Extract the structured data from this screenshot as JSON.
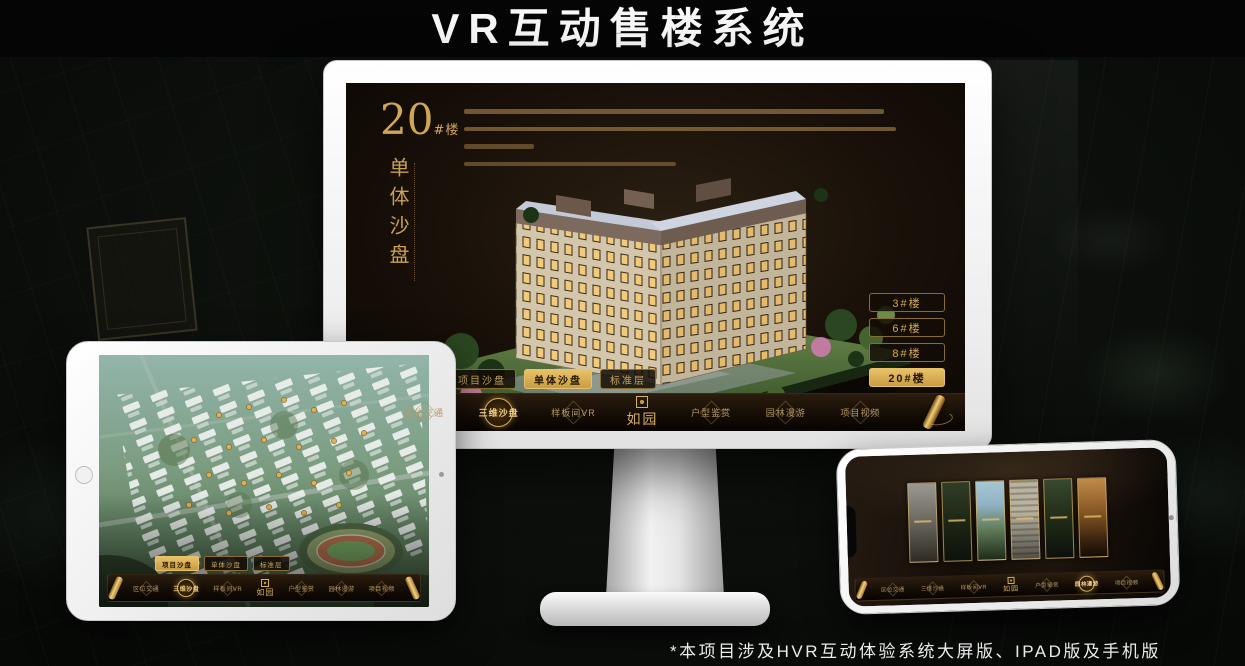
{
  "header": {
    "title": "VR互动售楼系统"
  },
  "footnote": "*本项目涉及HVR互动体验系统大屏版、IPAD版及手机版",
  "logo": {
    "text": "如园"
  },
  "nav": {
    "items": [
      {
        "label": "区位交通"
      },
      {
        "label": "三维沙盘"
      },
      {
        "label": "样板间VR"
      },
      {
        "label": "户型鉴赏"
      },
      {
        "label": "园林漫游"
      },
      {
        "label": "项目视频"
      }
    ]
  },
  "subtabs": {
    "items": [
      {
        "label": "项目沙盘"
      },
      {
        "label": "单体沙盘"
      },
      {
        "label": "标准层"
      }
    ]
  },
  "monitor": {
    "building_number": "20",
    "building_suffix": "#楼",
    "section_title": "单体沙盘",
    "active_subtab": "单体沙盘",
    "active_nav": "三维沙盘",
    "building_buttons": [
      {
        "label": "3#楼",
        "active": false
      },
      {
        "label": "6#楼",
        "active": false
      },
      {
        "label": "8#楼",
        "active": false
      },
      {
        "label": "20#楼",
        "active": true
      }
    ]
  },
  "tablet": {
    "active_subtab": "项目沙盘",
    "active_nav": "三维沙盘"
  },
  "phone": {
    "active_nav": "园林漫游"
  },
  "colors": {
    "gold": "#c9a050",
    "gold_bright": "#e9c169",
    "screen_bg": "#170f08",
    "page_bg": "#0b0e0b"
  }
}
